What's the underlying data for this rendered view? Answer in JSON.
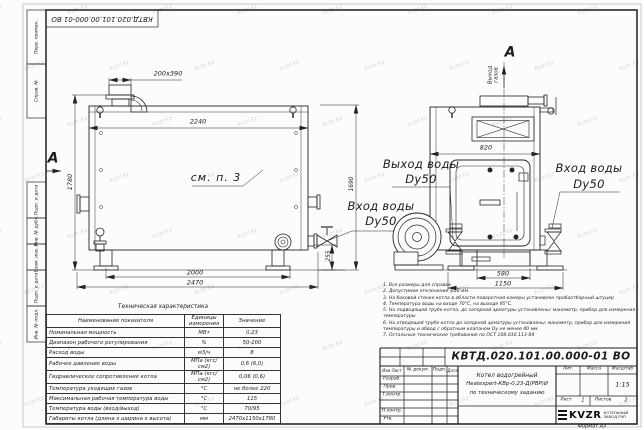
{
  "sheet": {
    "watermark_text": "kvzr.kz",
    "top_stamp": "КВТД.020.101.00.000-01 ВО",
    "format_note": "Формат  А3"
  },
  "margin_labels": [
    "Перв. примен.",
    "Справ. №",
    "Подп. и дата",
    "Инв. № дубл.",
    "Взам. инв. №",
    "Подп. и дата",
    "Инв. № подл."
  ],
  "front_view": {
    "section_letter": "А",
    "see_note_label": "см. п. 3",
    "dim_flue": "200x390",
    "dim_width_top": "2240",
    "dim_height": "1780",
    "dim_legs_span": "2000",
    "dim_length_overall": "2470",
    "dim_inlet_height": "255",
    "dim_height_right": "1690",
    "inlet_label_line1": "Вход воды",
    "inlet_label_line2": "Dy50",
    "outlet_label_line1": "Выход воды",
    "outlet_label_line2": "Dy50"
  },
  "side_view": {
    "section_letter": "А",
    "gas_outlet_label": "Выход\nгазов",
    "dim_width_top": "820",
    "dim_legs_span": "580",
    "dim_width_overall": "1150",
    "inlet_label_line1": "Вход воды",
    "inlet_label_line2": "Dy50"
  },
  "spec_table": {
    "title": "Техническая характеристика",
    "headers": [
      "Наименование показателя",
      "Единицы измерения",
      "Значение"
    ],
    "rows": [
      [
        "Номинальная мощность",
        "МВт",
        "0,23"
      ],
      [
        "Диапазон рабочего регулирования",
        "%",
        "50-100"
      ],
      [
        "Расход воды",
        "м3/ч",
        "8"
      ],
      [
        "Рабочее давление воды",
        "МПа (кгс/см2)",
        "0,6 (6,0)"
      ],
      [
        "Гидравлическое сопротивление котла",
        "МПа (кгс/см2)",
        "0,06 (0,6)"
      ],
      [
        "Температура уходящих газов",
        "°С",
        "не более 220"
      ],
      [
        "Максимальная рабочая температура воды",
        "°С",
        "115"
      ],
      [
        "Температура воды (вход/выход)",
        "°С",
        "70/95"
      ],
      [
        "Габариты котла (длина х ширина х высота)",
        "мм",
        "2470х1150х1780"
      ]
    ]
  },
  "notes": [
    "1. Все размеры для справок",
    "2. Допустимое отклонение ±10 мм.",
    "3. На боковой стенке котла в области поворотной камеры установлен пробоотборный штуцер",
    "4. Температура воды на входе 70°С, на выходе 95°С.",
    "5. На подводящей трубе котла, до запорной арматуры установлены: манометр, прибор для измерения температуры.",
    "6. На отводящей трубе котла до запорной арматуры установлены: манометр, прибор для измерения температуры и обвод с обратным клапаном Dу не менее 40 мм.",
    "7. Остальные технические требования по ОСТ 108.030.113-84"
  ],
  "title_block": {
    "doc_number": "КВТД.020.101.00.000-01  ВО",
    "name_line1": "Котел водогрейный",
    "name_line2": "Heatexpert-КВр-0,23-Д(РВР)И",
    "name_line3": "по техническому заданию",
    "col_izm_list": "Изм  Лист",
    "col_doc": "№ докум.",
    "col_sign": "Подп.",
    "col_date": "Дата",
    "row_developed": "Разраб.",
    "row_checked": "Пров.",
    "row_tcontrol": "Т.контр.",
    "row_ncontrol": "Н.контр.",
    "row_approved": "Утв.",
    "lit_label": "Лит.",
    "mass_label": "Масса",
    "scale_label": "Масштаб",
    "scale_value": "1:15",
    "sheet_label": "Лист",
    "sheet_value": "1",
    "sheets_label": "Листов",
    "sheets_value": "2",
    "logo_text": "KVZR",
    "logo_caption_line1": "КОТЕЛЬНЫЙ",
    "logo_caption_line2": "ЗАВОД РЭП"
  }
}
